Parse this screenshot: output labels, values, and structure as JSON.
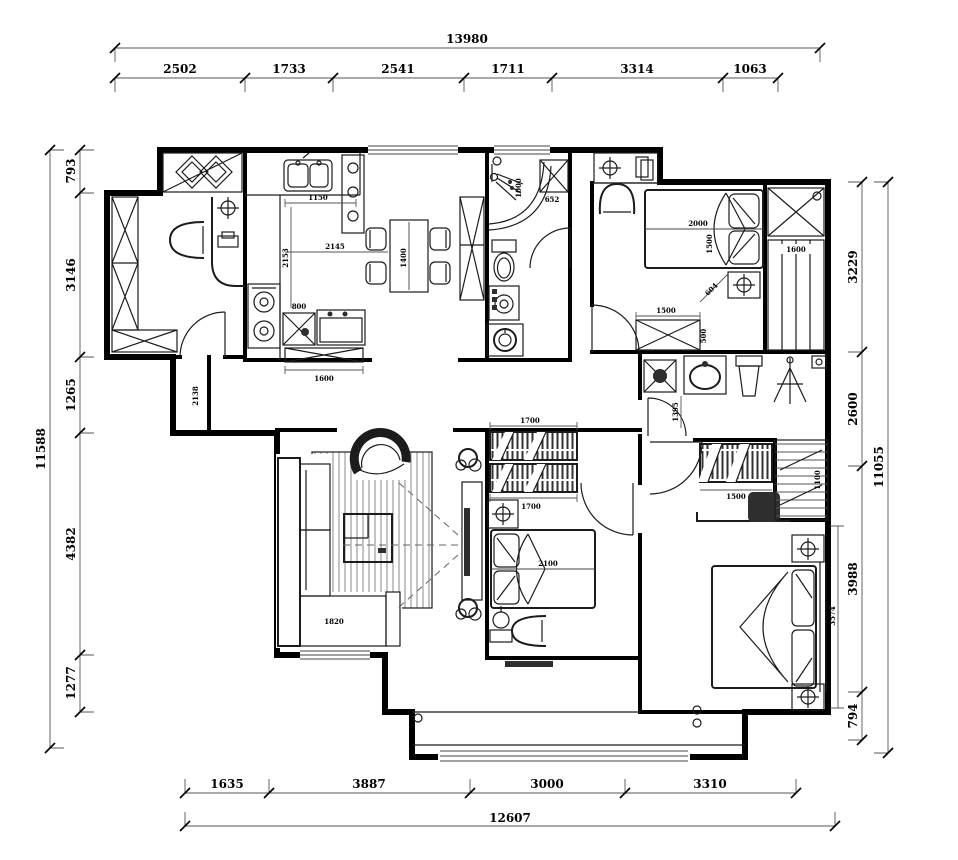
{
  "dims": {
    "top": {
      "total": "13980",
      "segments": [
        "2502",
        "1733",
        "2541",
        "1711",
        "3314",
        "1063"
      ]
    },
    "left": {
      "total": "11588",
      "segments": [
        "793",
        "3146",
        "1265",
        "4382",
        "1277"
      ]
    },
    "right": {
      "total": "11055",
      "segments": [
        "3229",
        "2600",
        "3988",
        "794"
      ]
    },
    "bottom": {
      "total": "12607",
      "segments": [
        "1635",
        "3887",
        "3000",
        "3310"
      ]
    }
  },
  "interior": {
    "kitchen_counter": "1150",
    "kitchen_width": "2145",
    "kitchen_depth": "2153",
    "dining_table": "1400",
    "kitchen_cab_small": "800",
    "kitchen_cab": "1600",
    "hallway": "2138",
    "bath1_w": "1000",
    "bath1_niche": "652",
    "bed2_len": "2000",
    "bed2_wid": "1500",
    "bed2_closet": "1600",
    "bed2_diag": "604",
    "bed2_wardrobe": "1500",
    "bed2_wardrobe_d": "500",
    "bath2_d": "1395",
    "master_shelf": "1500",
    "master_closet": "1100",
    "master_zone": "3574",
    "bed3_shelf_a": "1700",
    "bed3_shelf_b": "1700",
    "bed3_bed": "2100",
    "sofa": "1820"
  }
}
